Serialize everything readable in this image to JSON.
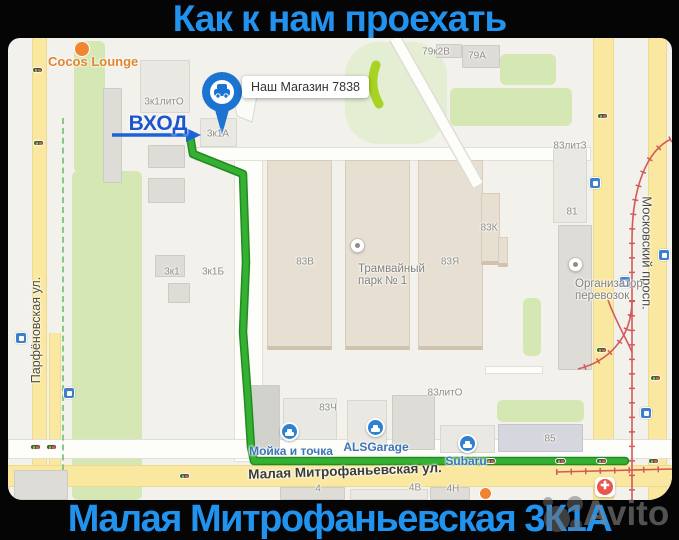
{
  "header": {
    "title": "Как к нам проехать"
  },
  "footer": {
    "title": "Малая Митрофаньевская 3К1А"
  },
  "watermark": {
    "text": "Avito"
  },
  "map": {
    "entrance_label": "ВХОД",
    "shop_tooltip": "Наш Магазин 7838",
    "streets": {
      "left": "Парфёновская ул.",
      "right": "Московский просп.",
      "bottom": "Малая Митрофаньевская ул."
    },
    "building_labels": [
      {
        "text": "3к1литО"
      },
      {
        "text": "3к1А"
      },
      {
        "text": "3к1"
      },
      {
        "text": "3к1Б"
      },
      {
        "text": "83В"
      },
      {
        "text": "83Я"
      },
      {
        "text": "83К"
      },
      {
        "text": "83литЗ"
      },
      {
        "text": "81"
      },
      {
        "text": "79к2В"
      },
      {
        "text": "79А"
      },
      {
        "text": "83Ч"
      },
      {
        "text": "83литО"
      },
      {
        "text": "85"
      },
      {
        "text": "4"
      },
      {
        "text": "4В"
      },
      {
        "text": "4Н"
      }
    ],
    "pois": {
      "cocos": "Cocos Lounge",
      "tram_park_line1": "Трамвайный",
      "tram_park_line2": "парк № 1",
      "org_line1": "Организатор",
      "org_line2": "перевозок",
      "alsgarage": "ALSGarage",
      "carwash": "Мойка и точка",
      "subaru": "Subaru"
    },
    "colors": {
      "route_green": "#2fa52d",
      "title_blue": "#2193ef",
      "entrance_blue": "#1c55cc",
      "road_yellow": "#fae8a0",
      "park_green": "#d5e8b4",
      "tram_red": "#d25a5a"
    }
  }
}
